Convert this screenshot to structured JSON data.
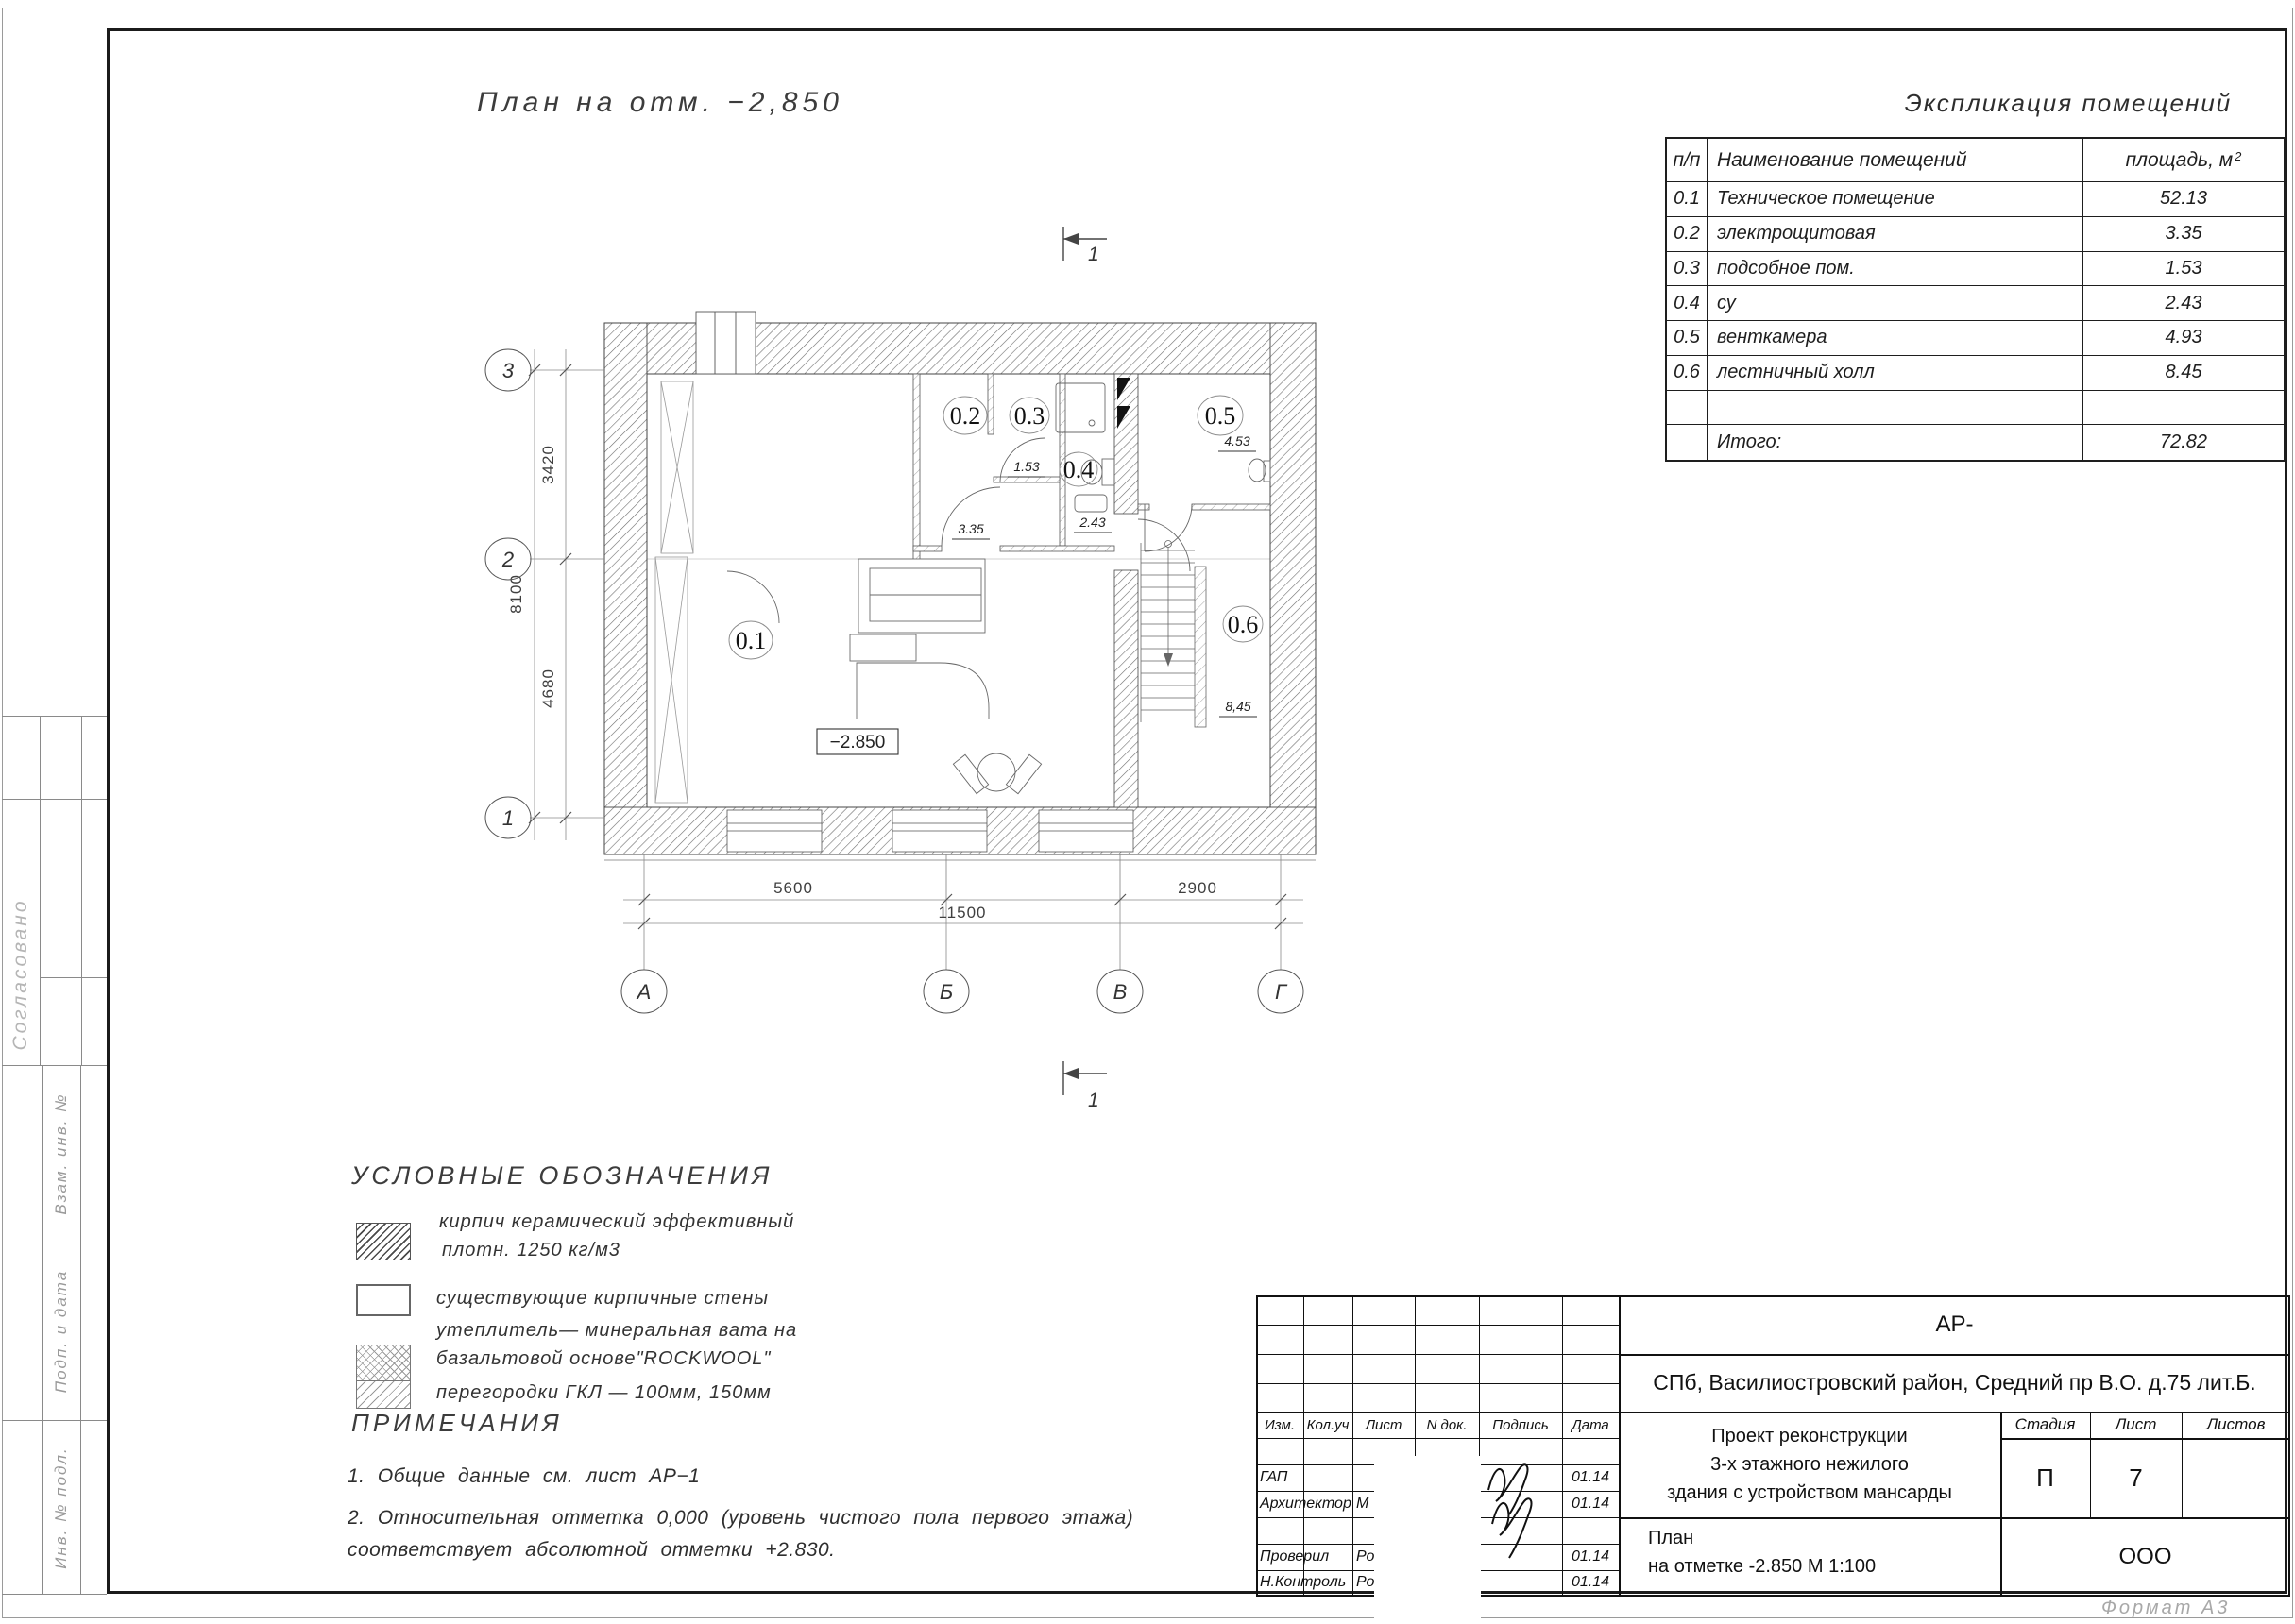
{
  "page": {
    "drawing_title": "План на отм.  −2,850",
    "format_note": "Формат А3"
  },
  "side_strip": {
    "approved": "Согласовано",
    "vzam": "Взам. инв. №",
    "podp": "Подп. и дата",
    "inv": "Инв. № подл."
  },
  "explication": {
    "title": "Экспликация помещений",
    "col_num": "п/п",
    "col_name": "Наименование помещений",
    "col_area": "площадь, м",
    "col_area_sup": "2",
    "rows": [
      {
        "num": "0.1",
        "name": "Техническое помещение",
        "area": "52.13"
      },
      {
        "num": "0.2",
        "name": "электрощитовая",
        "area": "3.35"
      },
      {
        "num": "0.3",
        "name": "подсобное пом.",
        "area": "1.53"
      },
      {
        "num": "0.4",
        "name": "су",
        "area": "2.43"
      },
      {
        "num": "0.5",
        "name": "венткамера",
        "area": "4.93"
      },
      {
        "num": "0.6",
        "name": "лестничный холл",
        "area": "8.45"
      },
      {
        "num": "",
        "name": "",
        "area": ""
      },
      {
        "num": "",
        "name": "Итого:",
        "area": "72.82"
      }
    ]
  },
  "plan": {
    "rooms": [
      {
        "id": "0.1",
        "area": ""
      },
      {
        "id": "0.2",
        "area": "3.35"
      },
      {
        "id": "0.3",
        "area": "1.53"
      },
      {
        "id": "0.4",
        "area": "2.43"
      },
      {
        "id": "0.5",
        "area": "4.53"
      },
      {
        "id": "0.6",
        "area": "8,45"
      }
    ],
    "level_mark": "−2.850",
    "dim_left_1": "3420",
    "dim_left_2": "4680",
    "dim_left_total": "8100",
    "dim_bottom_1": "5600",
    "dim_bottom_2": "2900",
    "dim_bottom_total": "11500",
    "axes_left": [
      "3",
      "2",
      "1"
    ],
    "axes_bottom": [
      "А",
      "Б",
      "В",
      "Г"
    ],
    "section_label": "1"
  },
  "legend": {
    "title": "УСЛОВНЫЕ ОБОЗНАЧЕНИЯ",
    "item1_line1": "кирпич керамический эффективный",
    "item1_line2": "плотн. 1250 кг/м3",
    "item2": "существующие кирпичные стены",
    "item3_line1": "утеплитель— минеральная вата на",
    "item3_line2": "базальтовой основе\"ROCKWOOL\"",
    "item4": "перегородки ГКЛ — 100мм, 150мм"
  },
  "notes": {
    "title": "ПРИМЕЧАНИЯ",
    "line1": "1.  Общие данные см.  лист АР−1",
    "line2": "2.  Относительная отметка 0,000 (уровень чистого пола первого этажа)",
    "line3": "соответствует абсолютной отметки +2.830."
  },
  "titleblock": {
    "code": "АР-",
    "address": "СПб, Василиостровский район, Средний пр В.О. д.75 лит.Б.",
    "col_izm": "Изм.",
    "col_koluch": "Кол.уч",
    "col_list": "Лист",
    "col_ndok": "N док.",
    "col_podpis": "Подпись",
    "col_data": "Дата",
    "rows": [
      {
        "role": "ГАП",
        "frag": "",
        "date": "01.14"
      },
      {
        "role": "Архитектор",
        "frag": "М",
        "date": "01.14"
      },
      {
        "role": "",
        "frag": "",
        "date": ""
      },
      {
        "role": "Проверил",
        "frag": "Ро",
        "date": "01.14"
      },
      {
        "role": "Н.Контроль",
        "frag": "Ро",
        "date": "01.14"
      }
    ],
    "project_line1": "Проект реконструкции",
    "project_line2": "3-х этажного нежилого",
    "project_line3": "здания с устройством мансарды",
    "title_line1": "План",
    "title_line2": "на отметке -2.850 М 1:100",
    "stage_label": "Стадия",
    "list_label": "Лист",
    "listov_label": "Листов",
    "stage": "П",
    "list_num": "7",
    "listov": "",
    "org": "ООО"
  }
}
